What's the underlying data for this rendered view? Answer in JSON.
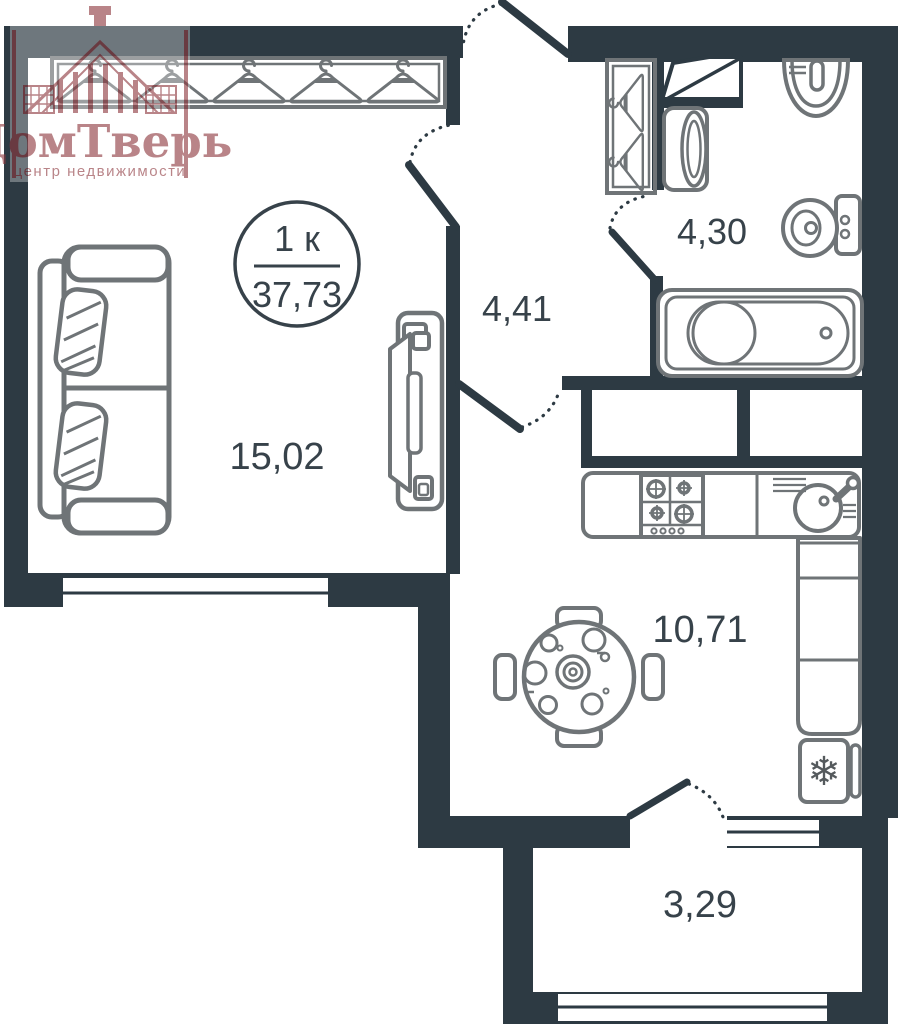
{
  "logo": {
    "brand": "ДомТверь",
    "tagline": "центр недвижимости",
    "color": "#8f3a40"
  },
  "badge": {
    "rooms_label": "1 к",
    "total_area": "37,73"
  },
  "rooms": {
    "living": {
      "area": "15,02"
    },
    "hallway": {
      "area": "4,41"
    },
    "bathroom": {
      "area": "4,30"
    },
    "kitchen": {
      "area": "10,71"
    },
    "balcony": {
      "area": "3,29"
    }
  },
  "icons": {
    "fridge_snowflake": "❄"
  },
  "colors": {
    "wall": "#2d3a43",
    "furniture_stroke": "#6f7477",
    "label_text": "#37424a"
  }
}
